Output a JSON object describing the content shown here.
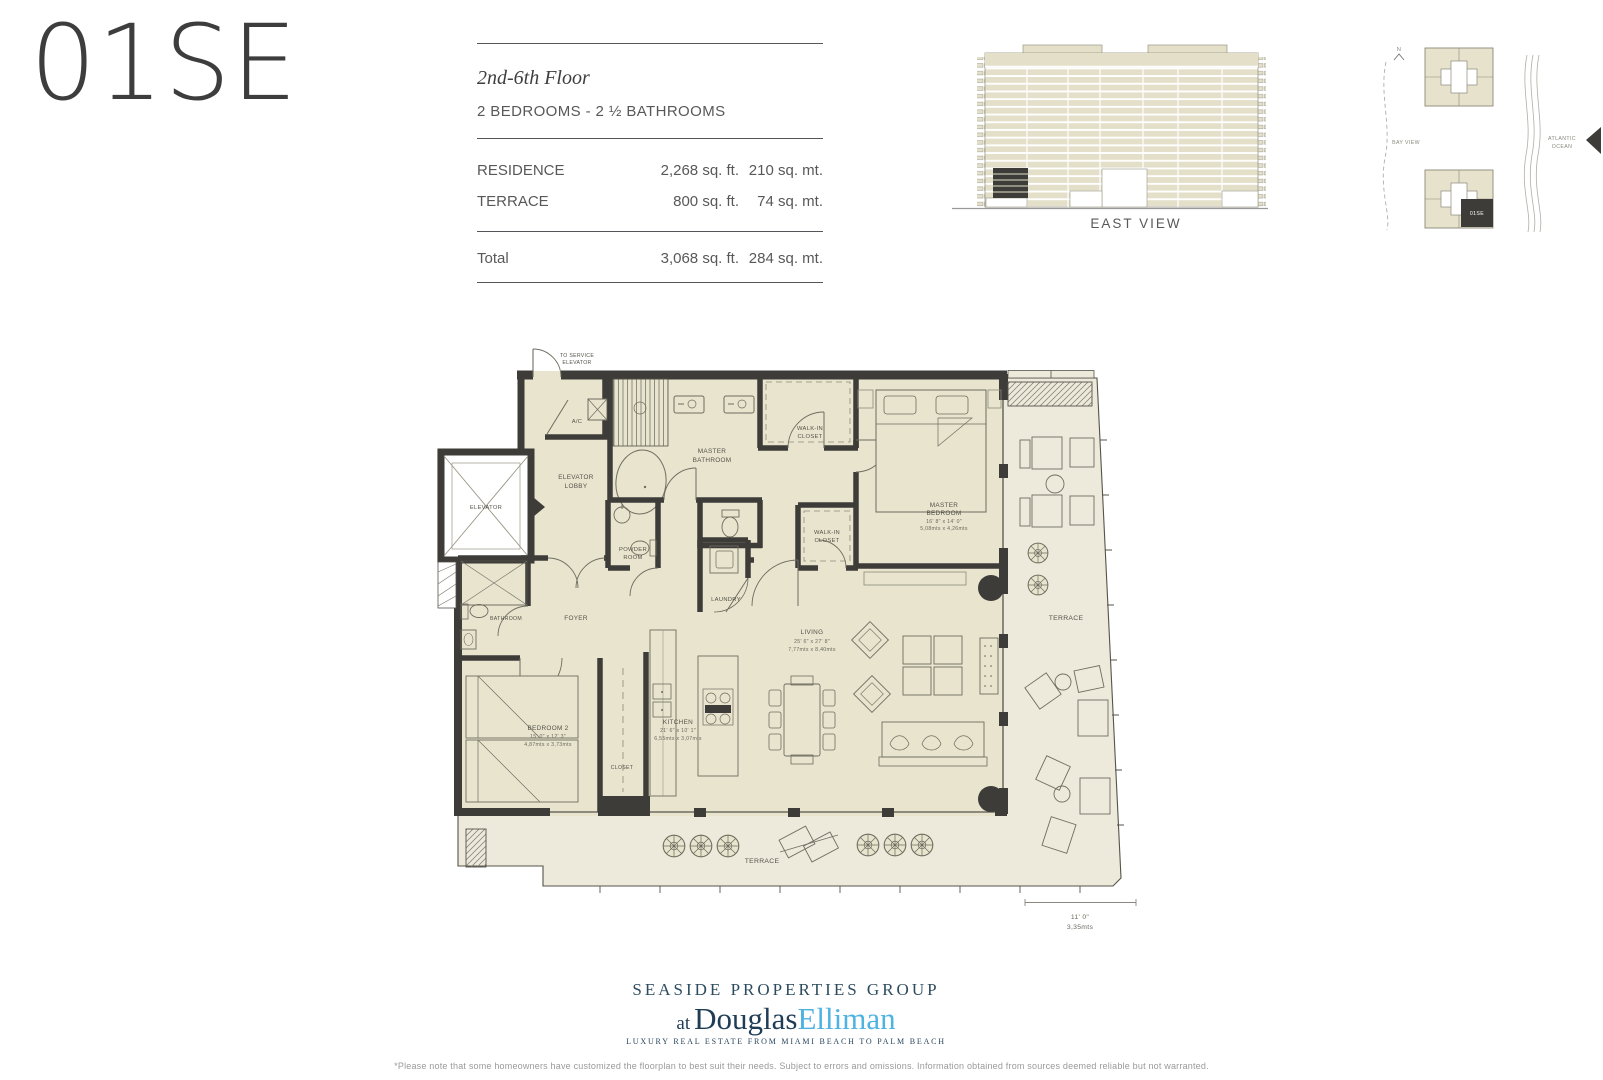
{
  "unit": {
    "id": "01SE"
  },
  "info": {
    "floor_range": "2nd-6th Floor",
    "bed_bath": "2 BEDROOMS - 2 ½ BATHROOMS",
    "rows": [
      {
        "label": "RESIDENCE",
        "sqft": "2,268 sq. ft.",
        "sqmt": "210 sq. mt."
      },
      {
        "label": "TERRACE",
        "sqft": "800 sq. ft.",
        "sqmt": "74 sq. mt."
      }
    ],
    "total": {
      "label": "Total",
      "sqft": "3,068 sq. ft.",
      "sqmt": "284 sq. mt."
    }
  },
  "east_view": {
    "caption": "EAST VIEW"
  },
  "site_plan": {
    "north_label": "N",
    "bay_label": "BAY VIEW",
    "ocean_label_1": "ATLANTIC",
    "ocean_label_2": "OCEAN",
    "unit_marker": "01SE"
  },
  "floorplan": {
    "labels": {
      "to_service_1": "TO SERVICE",
      "to_service_2": "ELEVATOR",
      "ac": "A/C",
      "elevator_lobby_1": "ELEVATOR",
      "elevator_lobby_2": "LOBBY",
      "elevator": "ELEVATOR",
      "master_bath_1": "MASTER",
      "master_bath_2": "BATHROOM",
      "powder_1": "POWDER",
      "powder_2": "ROOM",
      "laundry": "LAUNDRY",
      "wic_1": "WALK-IN",
      "wic_2": "CLOSET",
      "master_bed_1": "MASTER",
      "master_bed_2": "BEDROOM",
      "master_bed_dim_ft": "16' 8\" x 14' 0\"",
      "master_bed_dim_mt": "5,08mts x 4,26mts",
      "bathroom": "BATHROOM",
      "foyer": "FOYER",
      "bedroom2": "BEDROOM 2",
      "bedroom2_dim_ft": "15' 0\" x 12' 3\"",
      "bedroom2_dim_mt": "4,87mts x 3,73mts",
      "closet": "CLOSET",
      "kitchen": "KITCHEN",
      "kitchen_dim_ft": "21' 6\" x 10' 1\"",
      "kitchen_dim_mt": "6,55mts x 3,07mts",
      "living": "LIVING",
      "living_dim_ft": "25' 6\" x 27' 8\"",
      "living_dim_mt": "7,77mts x 8,40mts",
      "terrace_right": "TERRACE",
      "terrace_bottom": "TERRACE",
      "dim_ft": "11' 0\"",
      "dim_mt": "3,35mts"
    }
  },
  "footer": {
    "brand_line1": "SEASIDE PROPERTIES GROUP",
    "brand_at": "at",
    "brand_douglas": "Douglas",
    "brand_elliman": "Elliman",
    "tagline": "LUXURY REAL ESTATE FROM MIAMI BEACH TO PALM BEACH",
    "disclaimer": "*Please note that some homeowners have customized the floorplan to best suit their needs. Subject to errors and omissions. Information obtained from sources deemed reliable but not warranted."
  }
}
